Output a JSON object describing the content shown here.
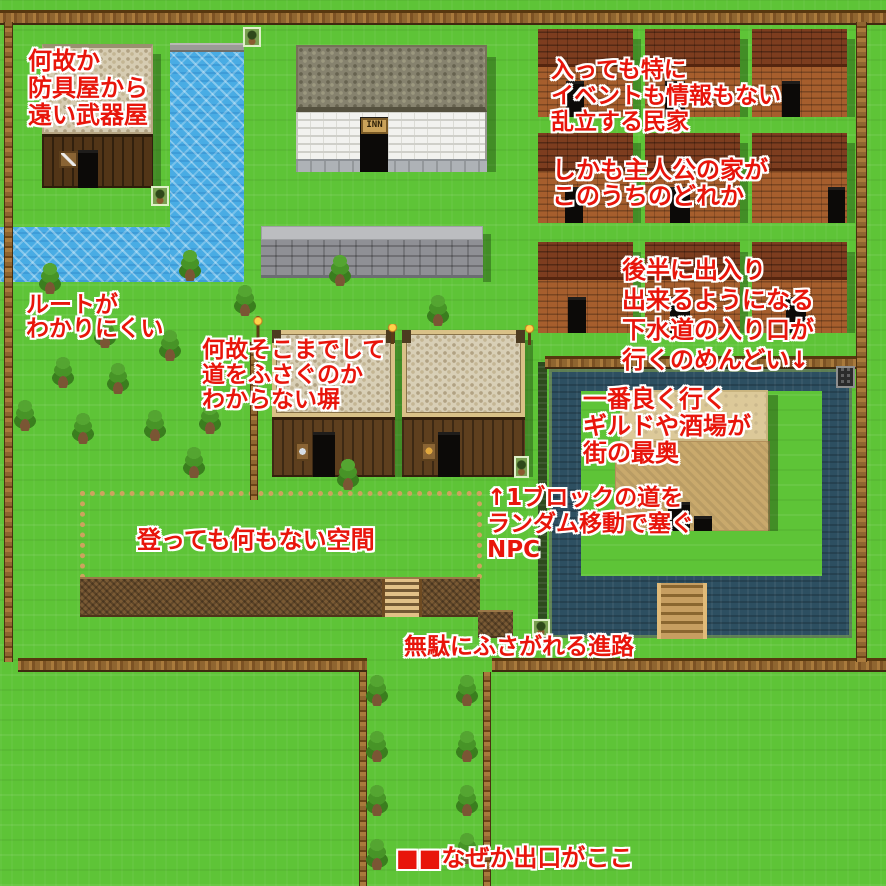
{
  "title": "RPG town map with design-criticism annotations",
  "colors": {
    "annotation_red": "#e8150b",
    "annotation_outline": "#ffffff",
    "grass": "#5ec437",
    "river_water": "#49ace4",
    "moat_water": "#2d4f61",
    "brick_house": "#a65e2d",
    "courtyard_sand": "#c9a96c",
    "fence_wood": "#8f6530"
  },
  "map": {
    "texts": {
      "inn_sign": "INN"
    },
    "rects": [
      {
        "n": "water-inlet",
        "c": "water",
        "x": 0,
        "y": 227,
        "w": 170,
        "h": 55
      },
      {
        "n": "river-lip",
        "c": "stonelip",
        "x": 170,
        "y": 43,
        "w": 74,
        "h": 9
      },
      {
        "n": "river",
        "c": "water",
        "x": 170,
        "y": 52,
        "w": 74,
        "h": 230
      },
      {
        "n": "empty-area-fence",
        "c": "dotfence",
        "x": 80,
        "y": 491,
        "w": 402,
        "h": 88
      },
      {
        "n": "cliff-ledge",
        "c": "cliff",
        "x": 80,
        "y": 577,
        "w": 400,
        "h": 40
      },
      {
        "n": "cliff-stub",
        "c": "cliff",
        "x": 478,
        "y": 610,
        "w": 35,
        "h": 28
      },
      {
        "n": "ladder",
        "c": "ladder",
        "x": 382,
        "y": 579,
        "w": 40,
        "h": 38,
        "i": true
      },
      {
        "n": "hedge",
        "c": "hedge",
        "x": 538,
        "y": 362,
        "w": 9,
        "h": 276
      },
      {
        "n": "moat",
        "c": "moat",
        "x": 549,
        "y": 369,
        "w": 303,
        "h": 269
      },
      {
        "n": "moat-island",
        "c": "grasspatch",
        "x": 581,
        "y": 391,
        "w": 241,
        "h": 185
      },
      {
        "n": "courtyard-upper",
        "c": "sand-light",
        "x": 620,
        "y": 390,
        "w": 148,
        "h": 51,
        "i": true
      },
      {
        "n": "courtyard-lower",
        "c": "sand-dark",
        "x": 615,
        "y": 441,
        "w": 155,
        "h": 90,
        "i": true
      },
      {
        "n": "courtyard-gap-1",
        "c": "doorway",
        "x": 668,
        "y": 502,
        "w": 22,
        "h": 29
      },
      {
        "n": "courtyard-gap-2",
        "c": "doorway",
        "x": 694,
        "y": 516,
        "w": 18,
        "h": 15
      },
      {
        "n": "courtyard-shadow",
        "c": "shadow",
        "x": 768,
        "y": 395,
        "w": 10,
        "h": 136
      },
      {
        "n": "bridge",
        "c": "bridge",
        "x": 657,
        "y": 583,
        "w": 50,
        "h": 56,
        "i": true
      },
      {
        "n": "fence-top",
        "c": "fenceh",
        "x": 0,
        "y": 10,
        "w": 886,
        "h": 15
      },
      {
        "n": "fence-moat",
        "c": "fenceh",
        "x": 545,
        "y": 356,
        "w": 311,
        "h": 13
      },
      {
        "n": "fence-bottom-left",
        "c": "fenceh",
        "x": 18,
        "y": 658,
        "w": 349,
        "h": 14
      },
      {
        "n": "fence-bottom-right",
        "c": "fenceh",
        "x": 492,
        "y": 658,
        "w": 394,
        "h": 14
      },
      {
        "n": "fence-left",
        "c": "fencev",
        "x": 4,
        "y": 22,
        "w": 9,
        "h": 640
      },
      {
        "n": "fence-right",
        "c": "fencev",
        "x": 856,
        "y": 22,
        "w": 11,
        "h": 640
      },
      {
        "n": "fence-corridor-left",
        "c": "fencev",
        "x": 359,
        "y": 672,
        "w": 8,
        "h": 214
      },
      {
        "n": "fence-corridor-right",
        "c": "fencev",
        "x": 483,
        "y": 672,
        "w": 8,
        "h": 214
      },
      {
        "n": "fence-mid",
        "c": "fencev",
        "x": 250,
        "y": 342,
        "w": 8,
        "h": 158
      },
      {
        "n": "weapon-shop-roof",
        "c": "roof-tan",
        "x": 42,
        "y": 44,
        "w": 111,
        "h": 90
      },
      {
        "n": "weapon-shop-wall",
        "c": "wall-dark",
        "x": 42,
        "y": 134,
        "w": 111,
        "h": 54
      },
      {
        "n": "weapon-shop-door",
        "c": "doorway",
        "x": 78,
        "y": 150,
        "w": 20,
        "h": 38,
        "i": true
      },
      {
        "n": "weapon-shop-sign",
        "c": "sign-sword",
        "x": 59,
        "y": 151,
        "w": 19,
        "h": 17
      },
      {
        "n": "weapon-shop-shadow",
        "c": "shadow",
        "x": 153,
        "y": 54,
        "w": 8,
        "h": 138
      },
      {
        "n": "inn-roof",
        "c": "roof-olive",
        "x": 296,
        "y": 45,
        "w": 191,
        "h": 67
      },
      {
        "n": "inn-wall",
        "c": "wall-brick",
        "x": 296,
        "y": 112,
        "w": 191,
        "h": 47
      },
      {
        "n": "inn-base",
        "c": "base-gray",
        "x": 296,
        "y": 159,
        "w": 191,
        "h": 13
      },
      {
        "n": "inn-door",
        "c": "doorway",
        "x": 360,
        "y": 117,
        "w": 28,
        "h": 55,
        "i": true
      },
      {
        "n": "inn-sign",
        "c": "sign-inn",
        "x": 361,
        "y": 118,
        "w": 27,
        "h": 16,
        "text": "inn_sign"
      },
      {
        "n": "inn-shadow",
        "c": "shadow",
        "x": 487,
        "y": 57,
        "w": 9,
        "h": 115
      },
      {
        "n": "stone-wall-top",
        "c": "wall-graytop",
        "x": 261,
        "y": 226,
        "w": 222,
        "h": 14
      },
      {
        "n": "stone-wall",
        "c": "wall-gray",
        "x": 261,
        "y": 240,
        "w": 222,
        "h": 38
      },
      {
        "n": "stone-wall-shadow",
        "c": "shadow",
        "x": 483,
        "y": 234,
        "w": 8,
        "h": 48
      },
      {
        "n": "armor-shop-roof",
        "c": "roof-frame",
        "x": 272,
        "y": 330,
        "w": 123,
        "h": 87
      },
      {
        "n": "armor-shop-wall",
        "c": "wall-planks",
        "x": 272,
        "y": 417,
        "w": 123,
        "h": 60
      },
      {
        "n": "armor-shop-door",
        "c": "doorway",
        "x": 313,
        "y": 432,
        "w": 22,
        "h": 45,
        "i": true
      },
      {
        "n": "armor-shop-sign",
        "c": "sign-shield",
        "x": 295,
        "y": 442,
        "w": 15,
        "h": 19
      },
      {
        "n": "armor-shop-shadow",
        "c": "shadow",
        "x": 395,
        "y": 340,
        "w": 7,
        "h": 137
      },
      {
        "n": "item-shop-roof",
        "c": "roof-frame",
        "x": 402,
        "y": 330,
        "w": 123,
        "h": 87
      },
      {
        "n": "item-shop-wall",
        "c": "wall-planks",
        "x": 402,
        "y": 417,
        "w": 123,
        "h": 60
      },
      {
        "n": "item-shop-door",
        "c": "doorway",
        "x": 438,
        "y": 432,
        "w": 22,
        "h": 45,
        "i": true
      },
      {
        "n": "item-shop-sign",
        "c": "sign-item",
        "x": 421,
        "y": 442,
        "w": 16,
        "h": 19
      },
      {
        "n": "item-shop-shadow",
        "c": "shadow",
        "x": 525,
        "y": 340,
        "w": 8,
        "h": 137
      },
      {
        "n": "sewer-grate",
        "c": "grate",
        "x": 836,
        "y": 366,
        "w": 19,
        "h": 22,
        "i": true
      }
    ],
    "houses": {
      "cols": [
        538,
        645,
        752
      ],
      "w": 95,
      "roof_h": 38,
      "rows": [
        {
          "y": 29,
          "h": 88
        },
        {
          "y": 133,
          "h": 90
        },
        {
          "y": 242,
          "h": 91
        }
      ],
      "doors": [
        [
          [
            28,
            18
          ],
          [
            20,
            20
          ],
          [
            30,
            18
          ]
        ],
        [
          [
            27,
            18
          ],
          [
            25,
            20
          ],
          [
            76,
            17
          ]
        ],
        [
          [
            30,
            18
          ],
          [
            25,
            20
          ],
          [
            34,
            20
          ]
        ]
      ]
    },
    "trees": [
      [
        38,
        262
      ],
      [
        178,
        249
      ],
      [
        328,
        254
      ],
      [
        233,
        284
      ],
      [
        93,
        316
      ],
      [
        158,
        329
      ],
      [
        426,
        294
      ],
      [
        51,
        356
      ],
      [
        106,
        362
      ],
      [
        13,
        399
      ],
      [
        71,
        412
      ],
      [
        143,
        409
      ],
      [
        198,
        402
      ],
      [
        182,
        446
      ],
      [
        336,
        458
      ],
      [
        365,
        674
      ],
      [
        365,
        730
      ],
      [
        365,
        784
      ],
      [
        365,
        838
      ],
      [
        455,
        674
      ],
      [
        455,
        730
      ],
      [
        455,
        784
      ],
      [
        455,
        832
      ]
    ],
    "npcs": [
      [
        243,
        27,
        18,
        20
      ],
      [
        151,
        186,
        18,
        20
      ],
      [
        514,
        456,
        15,
        22
      ],
      [
        532,
        619,
        18,
        18
      ]
    ],
    "lamps": [
      [
        251,
        316,
        14,
        28
      ],
      [
        386,
        324,
        13,
        20
      ],
      [
        523,
        325,
        13,
        20
      ]
    ]
  },
  "annotations": [
    {
      "id": "weapon-shop",
      "x": 28,
      "y": 48,
      "fs": 24,
      "lh": 27,
      "lines": [
        "何故か",
        "防具屋から",
        "遠い武器屋"
      ]
    },
    {
      "id": "houses",
      "x": 551,
      "y": 57,
      "fs": 23,
      "lh": 26,
      "lines": [
        "入っても特に",
        "イベントも情報もない",
        "乱立する民家"
      ]
    },
    {
      "id": "hero-house",
      "x": 552,
      "y": 157,
      "fs": 24,
      "lh": 26,
      "lines": [
        "しかも主人公の家が",
        "このうちのどれか"
      ]
    },
    {
      "id": "route",
      "x": 26,
      "y": 293,
      "fs": 23,
      "lh": 24,
      "lines": [
        "ルートが",
        "わかりにくい"
      ]
    },
    {
      "id": "wall",
      "x": 202,
      "y": 338,
      "fs": 23,
      "lh": 25,
      "lines": [
        "何故そこまでして",
        "道をふさぐのか",
        "わからない塀"
      ]
    },
    {
      "id": "sewer",
      "x": 622,
      "y": 255,
      "fs": 24,
      "lh": 30,
      "lines": [
        "後半に出入り",
        "出来るようになる",
        "下水道の入り口が",
        "行くのめんどい↓"
      ]
    },
    {
      "id": "guild",
      "x": 583,
      "y": 386,
      "fs": 24,
      "lh": 27,
      "lines": [
        "一番良く行く",
        "ギルドや酒場が",
        "街の最奥"
      ]
    },
    {
      "id": "npc-block",
      "x": 487,
      "y": 485,
      "fs": 23,
      "lh": 26,
      "lines": [
        "↑1ブロックの道を",
        "ランダム移動で塞ぐ",
        "NPC"
      ]
    },
    {
      "id": "empty-space",
      "x": 137,
      "y": 527,
      "fs": 24,
      "lh": 27,
      "lines": [
        "登っても何もない空間"
      ]
    },
    {
      "id": "blocked-path",
      "x": 404,
      "y": 634,
      "fs": 23,
      "lh": 26,
      "lines": [
        "無駄にふさがれる進路"
      ]
    },
    {
      "id": "exit",
      "x": 396,
      "y": 845,
      "fs": 24,
      "lh": 27,
      "lines": [
        "■■なぜか出口がここ"
      ]
    }
  ]
}
